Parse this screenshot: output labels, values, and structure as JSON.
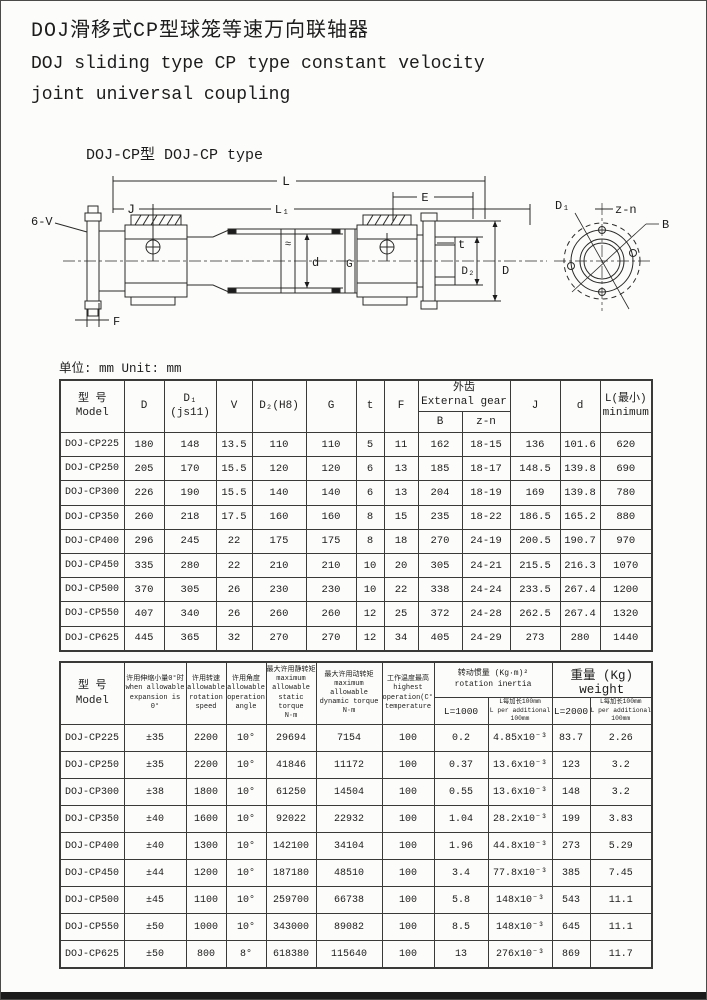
{
  "page": {
    "title_cn": "DOJ滑移式CP型球笼等速万向联轴器",
    "title_en1": "DOJ sliding type CP type constant velocity",
    "title_en2": "joint universal coupling",
    "subtitle": "DOJ-CP型 DOJ-CP type",
    "unit_note": "单位: mm Unit: mm"
  },
  "diagram": {
    "labels": {
      "L": "L",
      "J": "J",
      "L1": "L₁",
      "E": "E",
      "six_v": "6-V",
      "F": "F",
      "d": "d",
      "G": "G",
      "t": "t",
      "D2": "D₂",
      "D": "D",
      "D1": "D₁",
      "zn": "z-n",
      "B": "B",
      "approx": "≈"
    }
  },
  "table1": {
    "headers": {
      "model": "型 号\nModel",
      "D": "D",
      "D1": "D₁\n(js11)",
      "V": "V",
      "D2": "D₂(H8)",
      "G": "G",
      "t": "t",
      "F": "F",
      "external_gear": "外齿\nExternal gear",
      "B": "B",
      "zn": "z-n",
      "J": "J",
      "d": "d",
      "L": "L(最小)\nminimum"
    },
    "rows": [
      [
        "DOJ-CP225",
        "180",
        "148",
        "13.5",
        "110",
        "110",
        "5",
        "11",
        "162",
        "18-15",
        "136",
        "101.6",
        "620"
      ],
      [
        "DOJ-CP250",
        "205",
        "170",
        "15.5",
        "120",
        "120",
        "6",
        "13",
        "185",
        "18-17",
        "148.5",
        "139.8",
        "690"
      ],
      [
        "DOJ-CP300",
        "226",
        "190",
        "15.5",
        "140",
        "140",
        "6",
        "13",
        "204",
        "18-19",
        "169",
        "139.8",
        "780"
      ],
      [
        "DOJ-CP350",
        "260",
        "218",
        "17.5",
        "160",
        "160",
        "8",
        "15",
        "235",
        "18-22",
        "186.5",
        "165.2",
        "880"
      ],
      [
        "DOJ-CP400",
        "296",
        "245",
        "22",
        "175",
        "175",
        "8",
        "18",
        "270",
        "24-19",
        "200.5",
        "190.7",
        "970"
      ],
      [
        "DOJ-CP450",
        "335",
        "280",
        "22",
        "210",
        "210",
        "10",
        "20",
        "305",
        "24-21",
        "215.5",
        "216.3",
        "1070"
      ],
      [
        "DOJ-CP500",
        "370",
        "305",
        "26",
        "230",
        "230",
        "10",
        "22",
        "338",
        "24-24",
        "233.5",
        "267.4",
        "1200"
      ],
      [
        "DOJ-CP550",
        "407",
        "340",
        "26",
        "260",
        "260",
        "12",
        "25",
        "372",
        "24-28",
        "262.5",
        "267.4",
        "1320"
      ],
      [
        "DOJ-CP625",
        "445",
        "365",
        "32",
        "270",
        "270",
        "12",
        "34",
        "405",
        "24-29",
        "273",
        "280",
        "1440"
      ]
    ]
  },
  "table2": {
    "headers": {
      "model": "型 号\nModel",
      "expansion": "许用伸缩小量0°时\nwhen allowable\nexpansion is 0°",
      "speed": "许用转速\nallowable\nrotation\nspeed",
      "angle": "许用角度\nallowable\noperation\nangle",
      "static_torque": "最大许用静转矩\nmaximum allowable\nstatic torque\nN·m",
      "dynamic_torque": "最大许用动转矩\nmaximum allowable\ndynamic torque\nN·m",
      "temperature": "工作温度最高\nhighest\noperation(C°)\ntemperature",
      "inertia": "转动惯量 (Kg·m)²\nrotation inertia",
      "inertia_l1000": "L=1000",
      "inertia_per100": "L每加长100mm\nL per additional 100mm",
      "weight": "重量 (Kg) weight",
      "weight_l2000": "L=2000",
      "weight_per100": "L每加长100mm\nL per additional 100mm"
    },
    "rows": [
      [
        "DOJ-CP225",
        "±35",
        "2200",
        "10°",
        "29694",
        "7154",
        "100",
        "0.2",
        "4.85x10⁻³",
        "83.7",
        "2.26"
      ],
      [
        "DOJ-CP250",
        "±35",
        "2200",
        "10°",
        "41846",
        "11172",
        "100",
        "0.37",
        "13.6x10⁻³",
        "123",
        "3.2"
      ],
      [
        "DOJ-CP300",
        "±38",
        "1800",
        "10°",
        "61250",
        "14504",
        "100",
        "0.55",
        "13.6x10⁻³",
        "148",
        "3.2"
      ],
      [
        "DOJ-CP350",
        "±40",
        "1600",
        "10°",
        "92022",
        "22932",
        "100",
        "1.04",
        "28.2x10⁻³",
        "199",
        "3.83"
      ],
      [
        "DOJ-CP400",
        "±40",
        "1300",
        "10°",
        "142100",
        "34104",
        "100",
        "1.96",
        "44.8x10⁻³",
        "273",
        "5.29"
      ],
      [
        "DOJ-CP450",
        "±44",
        "1200",
        "10°",
        "187180",
        "48510",
        "100",
        "3.4",
        "77.8x10⁻³",
        "385",
        "7.45"
      ],
      [
        "DOJ-CP500",
        "±45",
        "1100",
        "10°",
        "259700",
        "66738",
        "100",
        "5.8",
        "148x10⁻³",
        "543",
        "11.1"
      ],
      [
        "DOJ-CP550",
        "±50",
        "1000",
        "10°",
        "343000",
        "89082",
        "100",
        "8.5",
        "148x10⁻³",
        "645",
        "11.1"
      ],
      [
        "DOJ-CP625",
        "±50",
        "800",
        "8°",
        "618380",
        "115640",
        "100",
        "13",
        "276x10⁻³",
        "869",
        "11.7"
      ]
    ]
  },
  "colors": {
    "ink": "#1c1c1c",
    "paper": "#fcfcfa"
  }
}
